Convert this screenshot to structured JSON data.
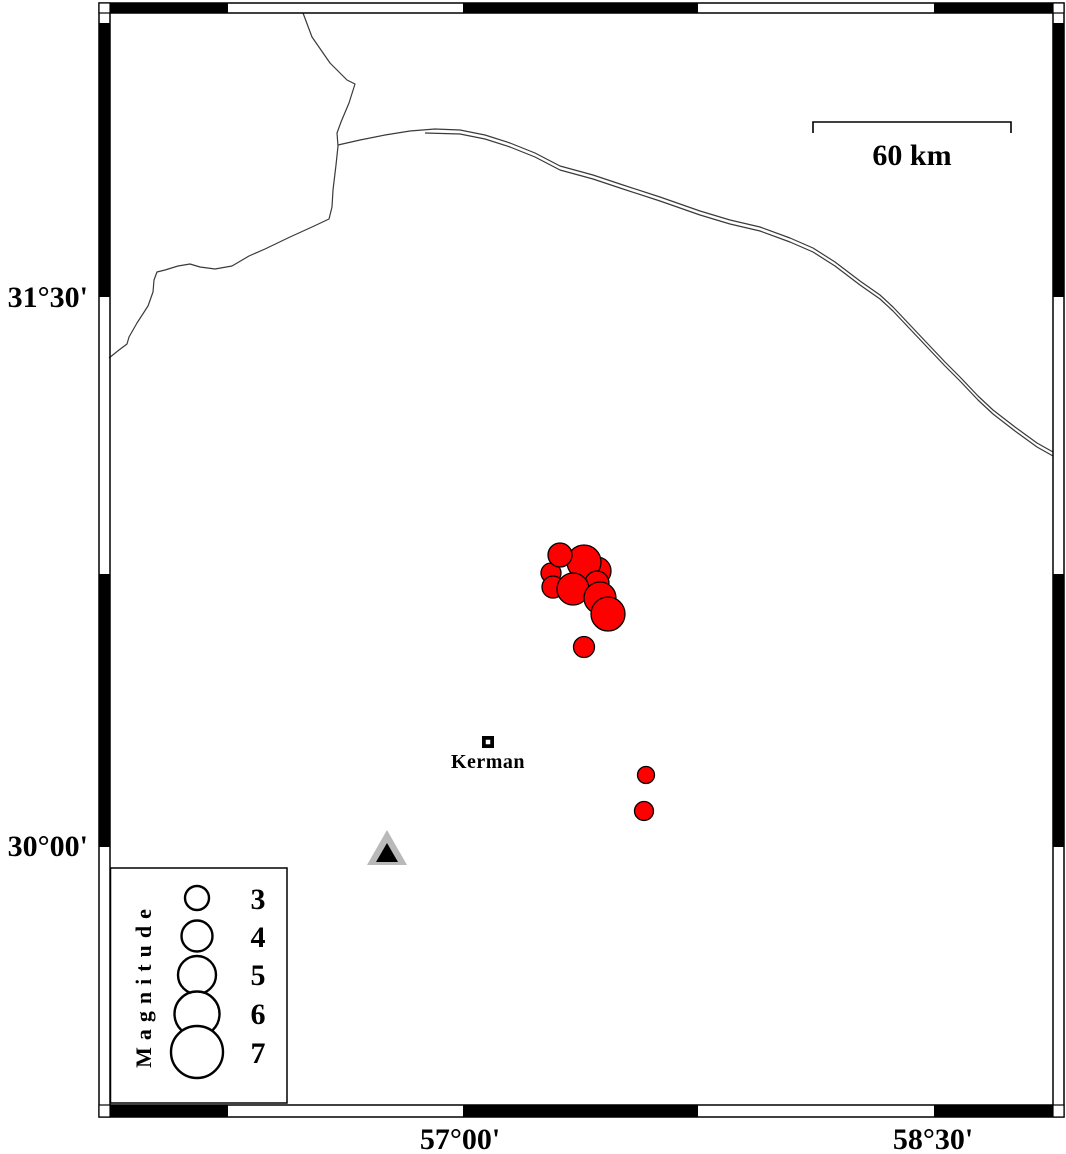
{
  "title": "Seismicity map of the Kerman region",
  "colors": {
    "background": "#ffffff",
    "frame": "#000000",
    "fault_line": "#3a3a3a",
    "earthquake_fill": "#ff0000",
    "earthquake_stroke": "#000000",
    "station_outer": "#b9b9b9",
    "station_inner": "#000000",
    "city_marker": "#000000"
  },
  "frame": {
    "outer": {
      "x": 99,
      "y": 3,
      "w": 965,
      "h": 1114
    },
    "inner": {
      "x": 110,
      "y": 13,
      "w": 943,
      "h": 1092
    },
    "top_segments": [
      [
        110,
        228
      ],
      [
        463,
        698
      ],
      [
        934,
        1053
      ]
    ],
    "bottom_segments": [
      [
        110,
        228
      ],
      [
        463,
        698
      ],
      [
        934,
        1053
      ]
    ],
    "left_segments": [
      [
        23,
        297
      ],
      [
        574,
        847
      ]
    ],
    "right_segments": [
      [
        23,
        297
      ],
      [
        574,
        847
      ]
    ]
  },
  "axis": {
    "left": [
      {
        "label": "31°30'",
        "y": 297
      },
      {
        "label": "30°00'",
        "y": 846
      }
    ],
    "bottom": [
      {
        "label": "57°00'",
        "x": 460
      },
      {
        "label": "58°30'",
        "x": 933
      }
    ]
  },
  "scale_bar": {
    "label": "60 km",
    "x1": 813,
    "x2": 1011,
    "y": 122,
    "tick": 11
  },
  "city": {
    "name": "Kerman",
    "marker": {
      "x": 488,
      "y": 742,
      "outer": 12,
      "inner": 4.5
    }
  },
  "station": {
    "outer_points": [
      [
        387,
        830
      ],
      [
        367,
        865
      ],
      [
        407,
        865
      ]
    ],
    "inner_points": [
      [
        387,
        843
      ],
      [
        376,
        862
      ],
      [
        398,
        862
      ]
    ]
  },
  "legend": {
    "title": "Magnitude",
    "box": {
      "x": 110.5,
      "y": 868,
      "w": 176.5,
      "h": 235
    },
    "circle_cx": 197,
    "label_x": 258,
    "entries": [
      {
        "magnitude": "3",
        "cy": 898,
        "r": 12
      },
      {
        "magnitude": "4",
        "cy": 936,
        "r": 15.5
      },
      {
        "magnitude": "5",
        "cy": 975,
        "r": 19
      },
      {
        "magnitude": "6",
        "cy": 1014,
        "r": 22.5
      },
      {
        "magnitude": "7",
        "cy": 1052,
        "r": 26
      }
    ]
  },
  "earthquakes": [
    {
      "x": 597,
      "y": 571,
      "r": 14
    },
    {
      "x": 584,
      "y": 562,
      "r": 17
    },
    {
      "x": 551,
      "y": 573,
      "r": 10
    },
    {
      "x": 597,
      "y": 583,
      "r": 12
    },
    {
      "x": 553,
      "y": 587,
      "r": 11
    },
    {
      "x": 560,
      "y": 555,
      "r": 12
    },
    {
      "x": 573,
      "y": 589,
      "r": 16
    },
    {
      "x": 600,
      "y": 598,
      "r": 16
    },
    {
      "x": 608,
      "y": 614,
      "r": 17
    },
    {
      "x": 584,
      "y": 647,
      "r": 10.5
    },
    {
      "x": 646,
      "y": 775,
      "r": 8.5
    },
    {
      "x": 644,
      "y": 811,
      "r": 9.5
    }
  ],
  "faults": [
    {
      "name": "fault-west-branch",
      "points": [
        [
          303,
          13
        ],
        [
          312,
          37
        ],
        [
          330,
          63
        ],
        [
          347,
          80
        ],
        [
          355,
          84
        ],
        [
          349,
          103
        ],
        [
          341,
          122
        ],
        [
          337,
          133
        ],
        [
          338,
          146
        ],
        [
          336,
          165
        ],
        [
          333,
          190
        ],
        [
          332,
          207
        ],
        [
          329,
          219
        ],
        [
          312,
          227
        ],
        [
          290,
          237
        ],
        [
          265,
          249
        ],
        [
          249,
          256
        ],
        [
          232,
          266
        ],
        [
          215,
          269
        ],
        [
          200,
          267
        ],
        [
          190,
          264
        ],
        [
          178,
          266
        ],
        [
          165,
          270
        ],
        [
          157,
          272
        ],
        [
          154,
          280
        ],
        [
          153,
          292
        ],
        [
          148,
          306
        ],
        [
          137,
          323
        ],
        [
          129,
          337
        ],
        [
          127,
          344
        ],
        [
          119,
          350
        ],
        [
          109,
          358
        ]
      ]
    },
    {
      "name": "fault-east-upper",
      "points": [
        [
          338,
          145
        ],
        [
          360,
          140
        ],
        [
          385,
          135
        ],
        [
          410,
          131
        ],
        [
          435,
          129
        ],
        [
          460,
          130
        ],
        [
          485,
          135
        ],
        [
          510,
          143
        ],
        [
          535,
          153
        ],
        [
          560,
          166
        ],
        [
          593,
          175
        ],
        [
          620,
          184
        ],
        [
          660,
          197
        ],
        [
          700,
          211
        ],
        [
          730,
          220
        ],
        [
          760,
          227
        ],
        [
          790,
          238
        ],
        [
          813,
          248
        ],
        [
          835,
          262
        ],
        [
          860,
          281
        ],
        [
          880,
          295
        ],
        [
          893,
          307
        ],
        [
          910,
          325
        ],
        [
          927,
          343
        ],
        [
          945,
          362
        ],
        [
          960,
          377
        ],
        [
          978,
          396
        ],
        [
          993,
          410
        ],
        [
          1015,
          427
        ],
        [
          1037,
          443
        ],
        [
          1053,
          452
        ]
      ]
    },
    {
      "name": "fault-east-lower",
      "points": [
        [
          425,
          133
        ],
        [
          460,
          134
        ],
        [
          485,
          139
        ],
        [
          510,
          147
        ],
        [
          535,
          157
        ],
        [
          560,
          170
        ],
        [
          593,
          179
        ],
        [
          620,
          188
        ],
        [
          660,
          201
        ],
        [
          700,
          215
        ],
        [
          730,
          224
        ],
        [
          760,
          231
        ],
        [
          790,
          242
        ],
        [
          813,
          252
        ],
        [
          835,
          266
        ],
        [
          860,
          285
        ],
        [
          880,
          299
        ],
        [
          893,
          311
        ],
        [
          910,
          329
        ],
        [
          927,
          347
        ],
        [
          945,
          366
        ],
        [
          960,
          381
        ],
        [
          978,
          400
        ],
        [
          993,
          414
        ],
        [
          1015,
          431
        ],
        [
          1037,
          447
        ],
        [
          1053,
          456
        ]
      ]
    }
  ]
}
